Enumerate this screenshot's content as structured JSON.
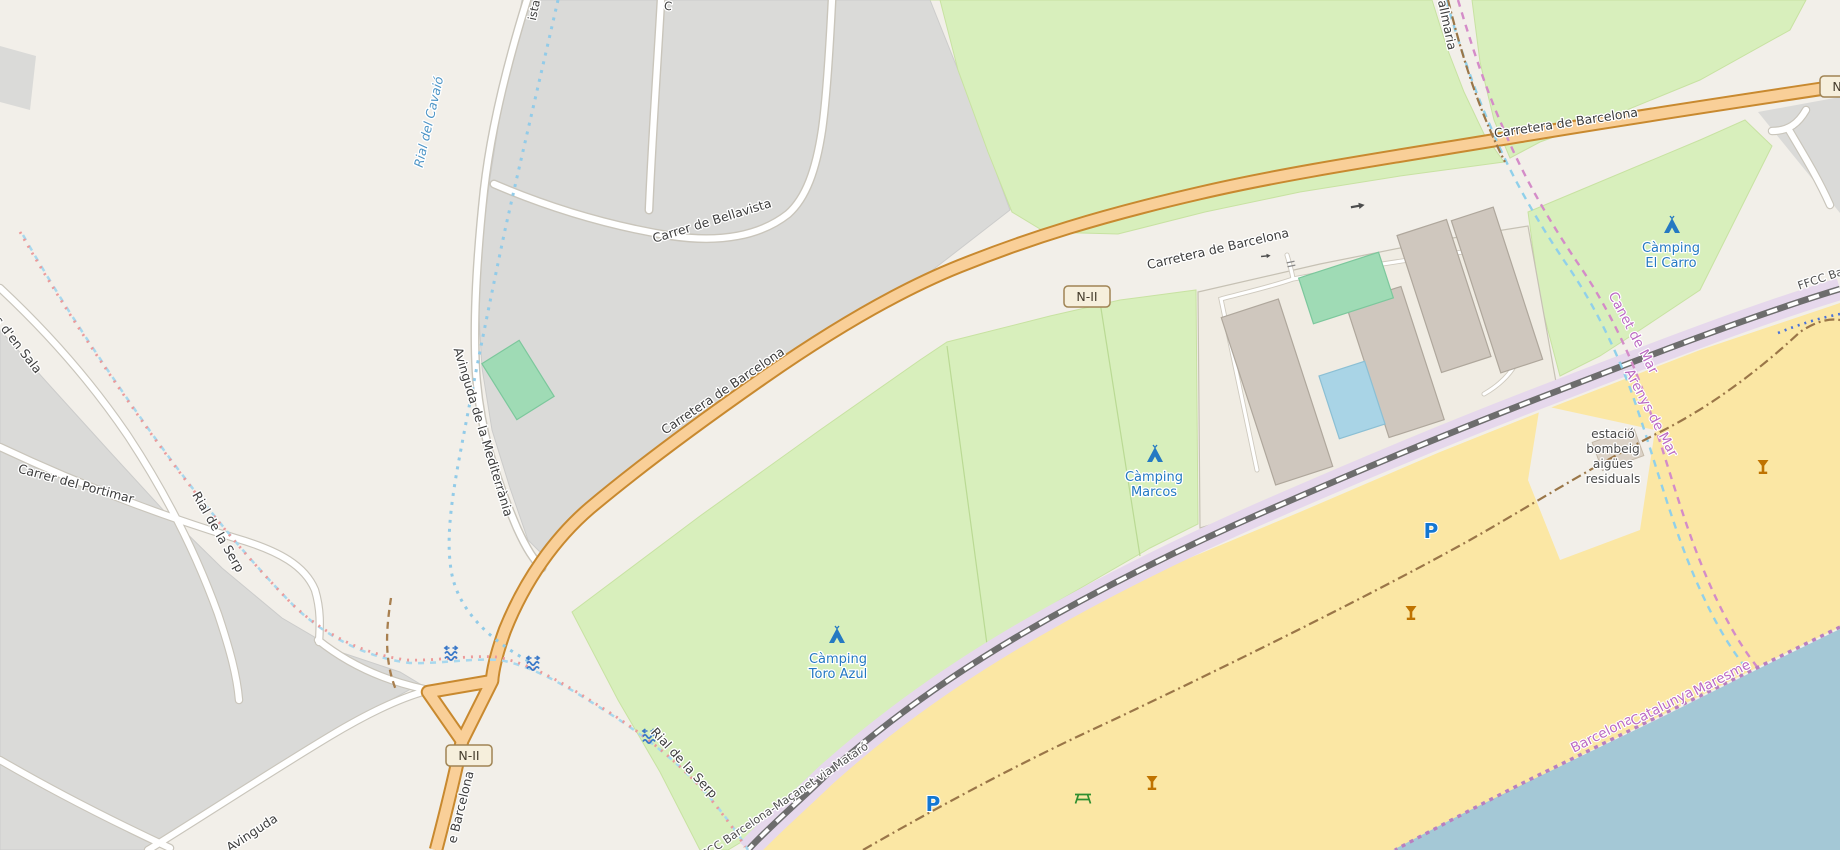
{
  "map": {
    "labels": {
      "carretera": "Carretera de Barcelona",
      "carretera_frag": "e Barcelona",
      "bellavista": "Carrer de Bellavista",
      "mediterrania": "Avinguda de la Mediterrània",
      "portimar": "Carrer del Portimar",
      "sala_frag": "s d'en Sala",
      "avinguda_frag": "Avinguda",
      "ista_frag": "ista",
      "c_frag": "C",
      "vallmaria_frag": "allmaria",
      "cavaio": "Rial del Cavaió",
      "serp": "Rial de la Serp",
      "ffcc": "FFCC Barcelona-Maçanet via Mataró",
      "estacio_1": "estació",
      "estacio_2": "bombeig",
      "estacio_3": "aigües",
      "estacio_4": "residuals",
      "camping": "Càmping",
      "toro": "Toro Azul",
      "marcos": "Marcos",
      "carro": "El Carro",
      "barcelona": "Barcelona",
      "catalunya": "Catalunya",
      "maresme": "Maresme",
      "canet": "Canet de Mar",
      "arenys": "Arenys de Mar",
      "route_badge": "N-II",
      "parking": "P"
    },
    "colors": {
      "land": "#f2efe9",
      "urban_gray": "#dadad8",
      "campsite_green": "#d8efbc",
      "sand": "#fbe7a4",
      "sea": "#a4c8d6",
      "trunk_fill": "#f9cf98",
      "trunk_casing": "#c8892f",
      "railway_corridor": "#e6d8ec",
      "railway_gray": "#6d6d6d",
      "boundary_purple": "#b87fc0",
      "stream_blue": "#92cbe8",
      "track_brown": "#9a7648",
      "poi_blue": "#2579c2",
      "bar_amber": "#bf7300",
      "picnic_green": "#2f8f2f",
      "building": "#cfc7be",
      "pool": "#a9d4e6",
      "pitch_teal": "#9fdbb5"
    }
  }
}
